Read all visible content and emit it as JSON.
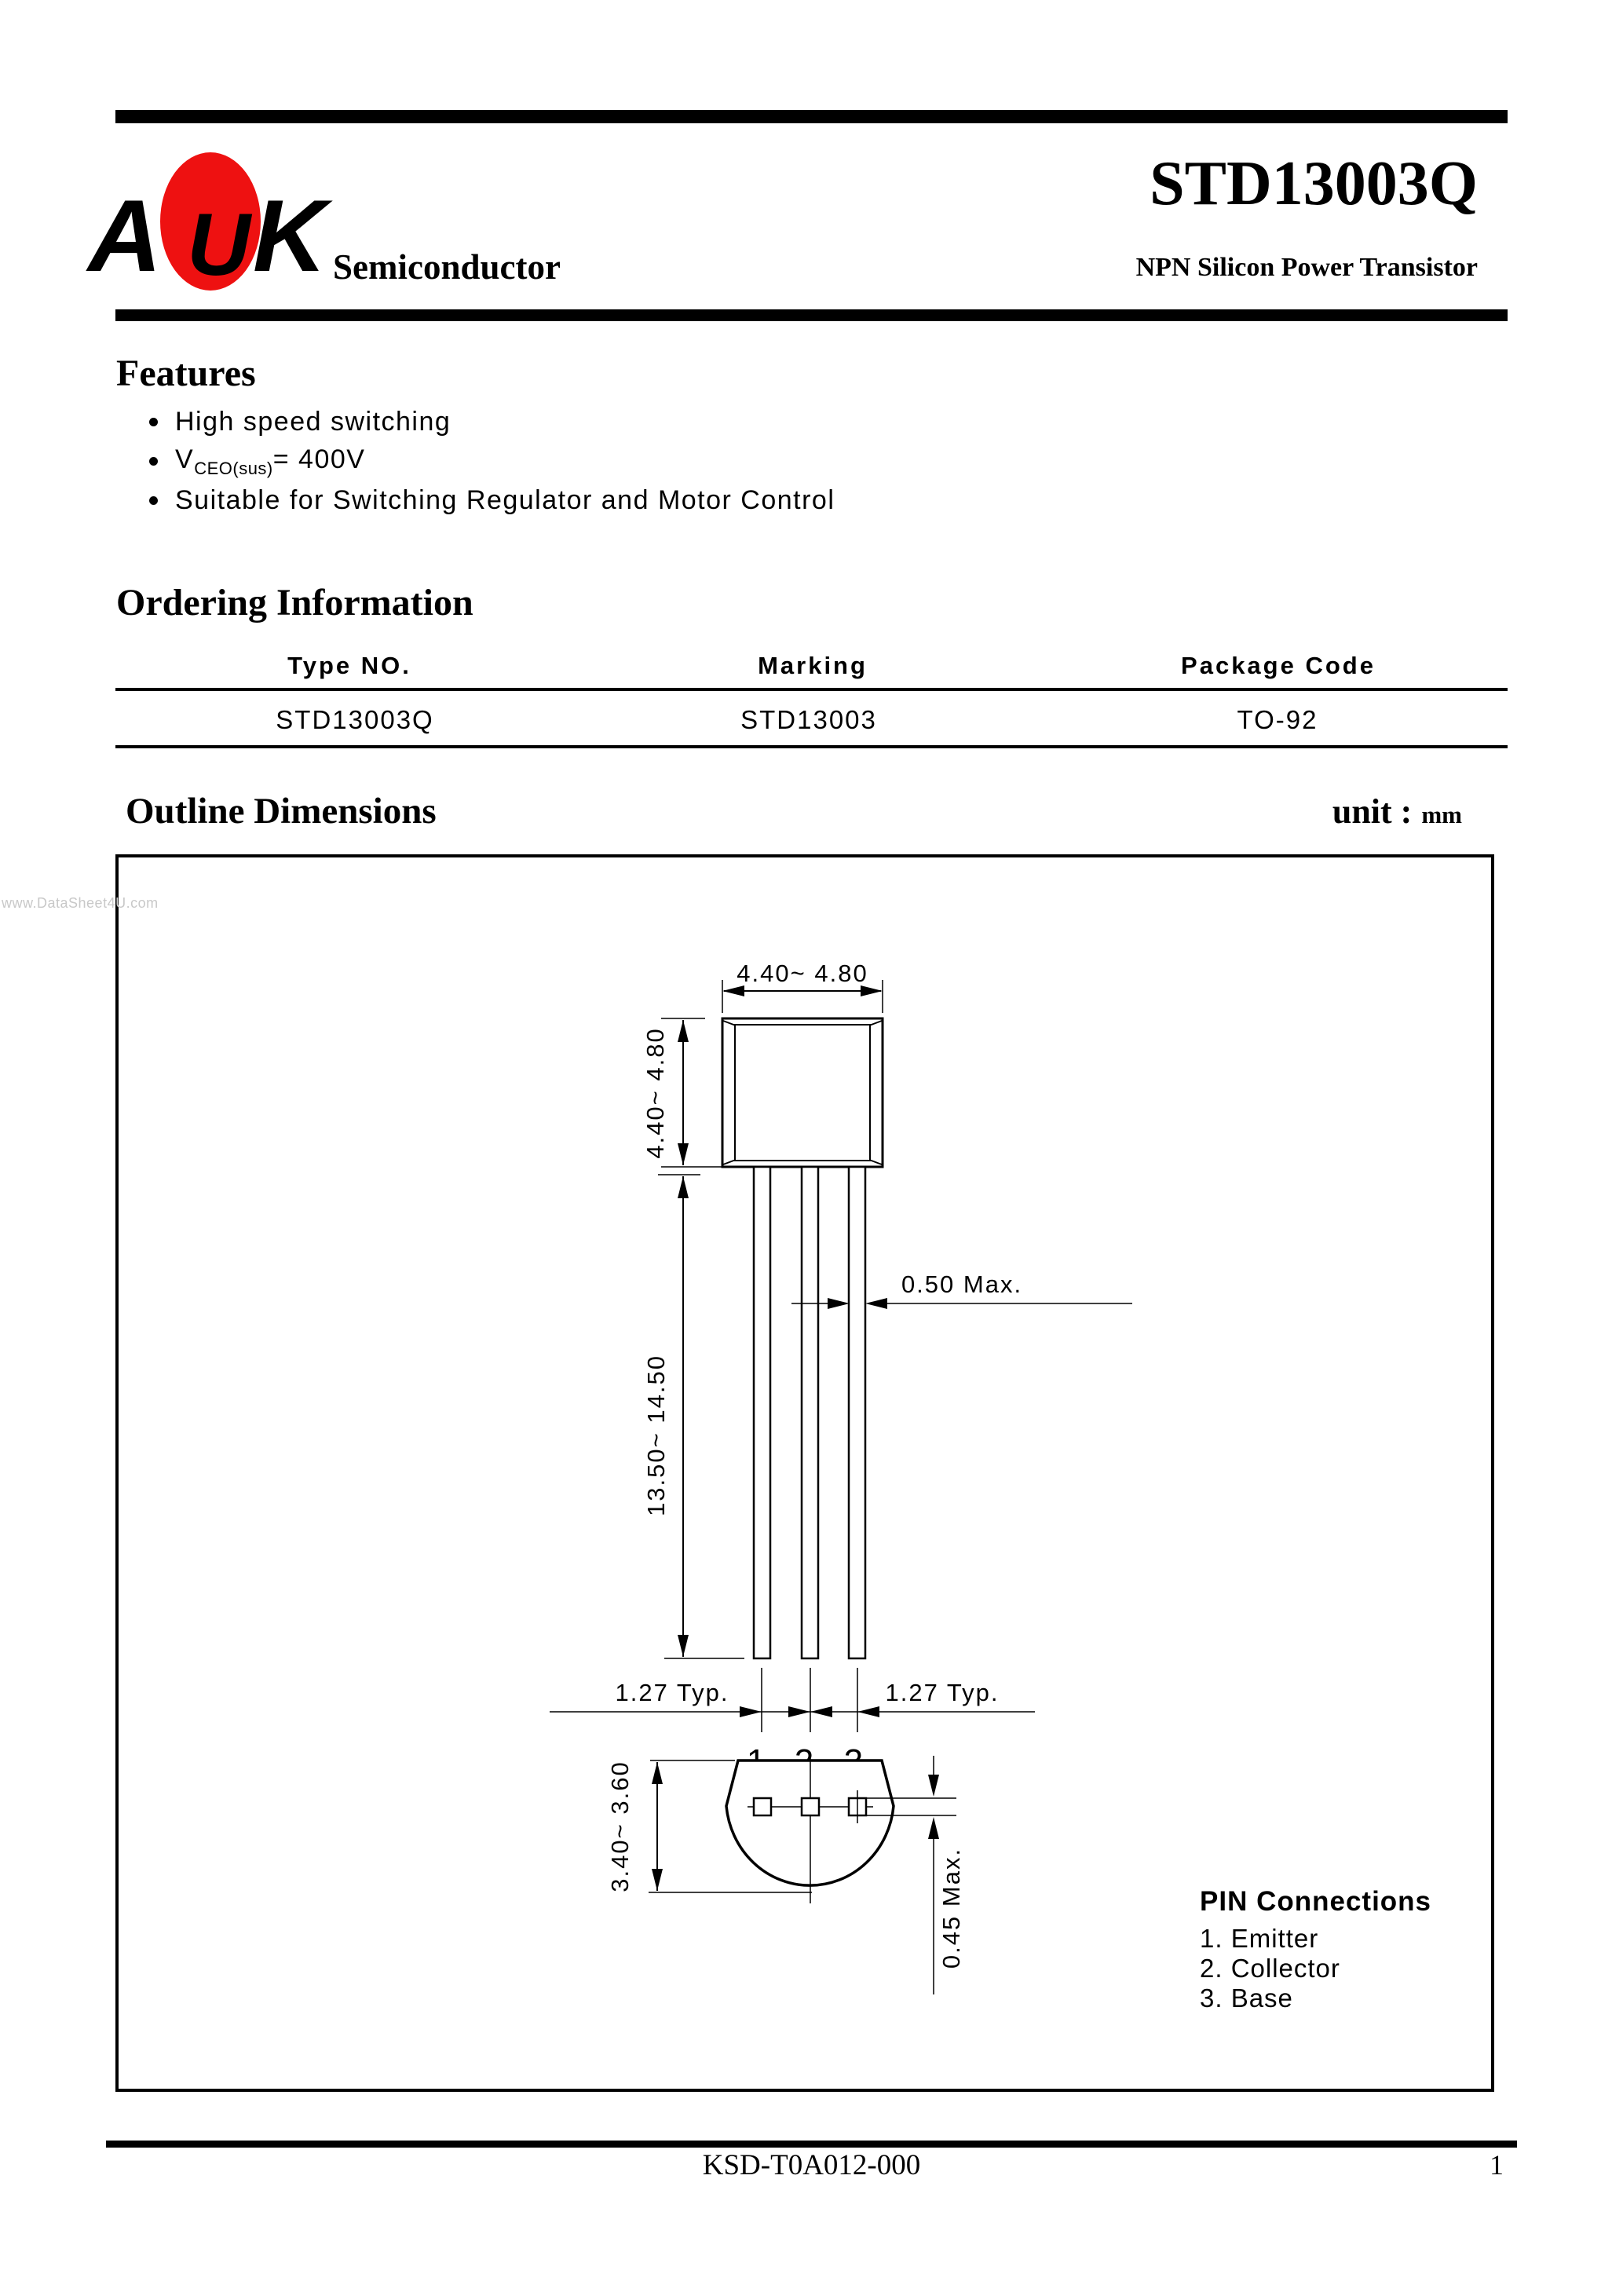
{
  "header": {
    "logo_a": "A",
    "logo_u": "U",
    "logo_k": "K",
    "logo_text": "Semiconductor",
    "logo_red": "#ee1111",
    "title": "STD13003Q",
    "subtitle": "NPN Silicon Power Transistor"
  },
  "features": {
    "heading": "Features",
    "item1": "High speed switching",
    "item2_v": "V",
    "item2_sub": "CEO(sus)",
    "item2_eq": "= 400V",
    "item3": "Suitable for Switching Regulator and Motor Control"
  },
  "ordering": {
    "heading": "Ordering Information",
    "col1": "Type NO.",
    "col2": "Marking",
    "col3": "Package Code",
    "val1": "STD13003Q",
    "val2": "STD13003",
    "val3": "TO-92"
  },
  "outline": {
    "heading": "Outline Dimensions",
    "unit_label": "unit :",
    "unit_value": "mm"
  },
  "diagram": {
    "front_width": "4.40~ 4.80",
    "front_height": "4.40~ 4.80",
    "lead_length": "13.50~ 14.50",
    "lead_width": "0.50 Max.",
    "pitch_left": "1.27 Typ.",
    "pitch_right": "1.27 Typ.",
    "pin1": "1",
    "pin2": "2",
    "pin3": "3",
    "bottom_height": "3.40~ 3.60",
    "standoff": "0.45 Max.",
    "pin_connections_title": "PIN Connections",
    "pin_conn1": "1. Emitter",
    "pin_conn2": "2. Collector",
    "pin_conn3": "3. Base"
  },
  "footer": {
    "doc_number": "KSD-T0A012-000",
    "page": "1"
  },
  "watermark": "www.DataSheet4U.com"
}
